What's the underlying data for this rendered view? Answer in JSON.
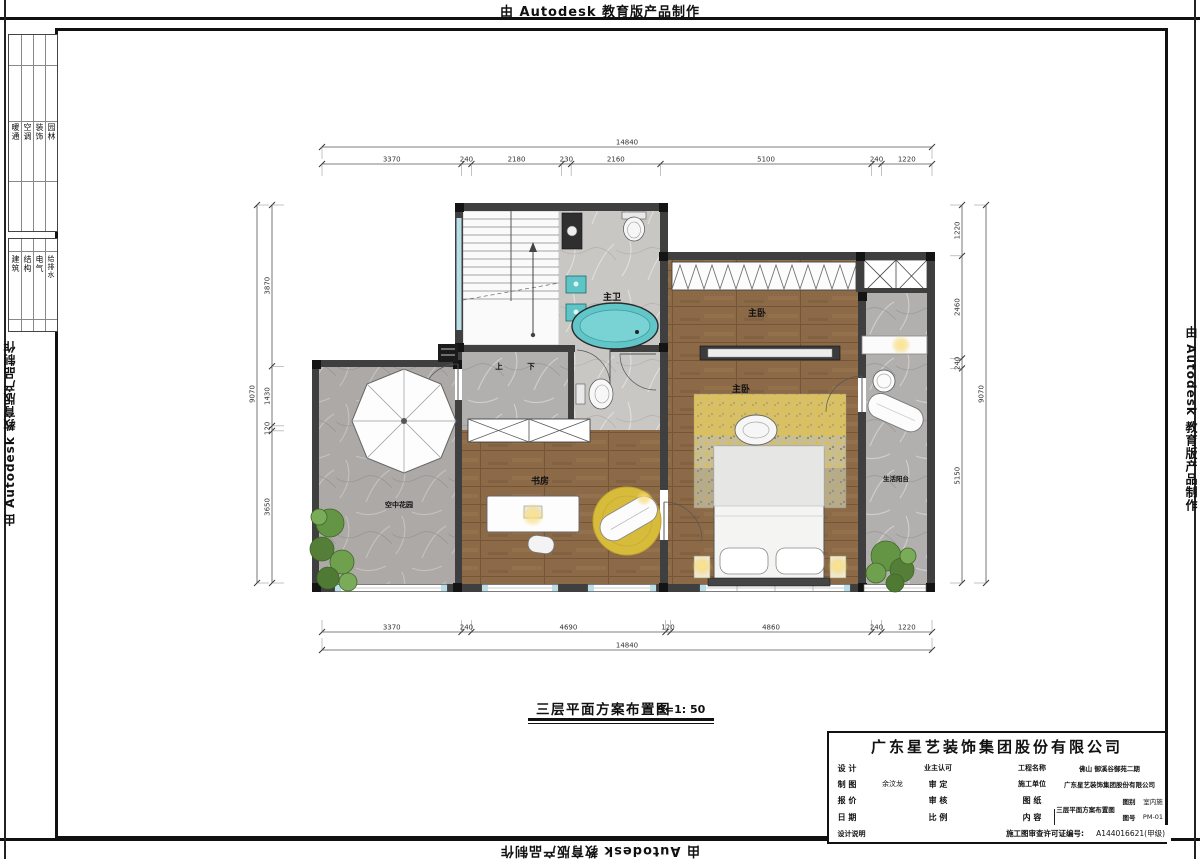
{
  "banners": {
    "autodesk": "由 Autodesk 教育版产品制作"
  },
  "side_tables": {
    "band1": [
      "暖通",
      "空调",
      "装饰",
      "园林"
    ],
    "band2": [
      "建筑",
      "结构",
      "电气",
      "给排水"
    ]
  },
  "plan": {
    "title": "三层平面方案布置图",
    "scale_text": "S=1: 50",
    "rooms": [
      {
        "label": "主卫"
      },
      {
        "label": "主卧"
      },
      {
        "label": "主卧"
      },
      {
        "label": "书房"
      },
      {
        "label": "空中花园"
      },
      {
        "label": "生活阳台"
      },
      {
        "label": "上"
      },
      {
        "label": "下"
      }
    ]
  },
  "dimensions": {
    "top_overall": "14840",
    "top_segments": [
      "3370",
      "240",
      "2180",
      "230",
      "2160",
      "5100",
      "240",
      "1220"
    ],
    "bottom_overall": "14840",
    "bottom_segments": [
      "3370",
      "240",
      "4690",
      "120",
      "4860",
      "240",
      "1220"
    ],
    "left_overall": "9070",
    "left_segments": [
      "3870",
      "1430",
      "120",
      "3650"
    ],
    "right_overall": "9070",
    "right_segments": [
      "1220",
      "2460",
      "240",
      "5150"
    ]
  },
  "title_block": {
    "company": "广东星艺装饰集团股份有限公司",
    "fields": {
      "design_label": "设 计",
      "owner_label": "业主认可",
      "project_label": "工程名称",
      "project_value": "佛山 御溪谷御苑二期",
      "draft_label": "制 图",
      "draft_value": "余汶龙",
      "approve_label": "审 定",
      "contractor_label": "施工单位",
      "contractor_value": "广东星艺装饰集团股份有限公司",
      "quote_label": "报 价",
      "check_label": "审 核",
      "drawing_label": "图 纸",
      "content_label": "内 容",
      "drawing_value": "三层平面方案布置图",
      "category_label": "图别",
      "category_value": "室内施",
      "number_label": "图号",
      "number_value": "PM-01",
      "date_label": "日 期",
      "scale_label": "比 例",
      "notes_label": "设计说明",
      "permit_label": "施工图审查许可证编号:",
      "permit_value": "A144016621(甲级)"
    }
  },
  "colors": {
    "wood": "#8d6a47",
    "marble": "#b2b0ae",
    "teal_fixture": "#5fc4c6",
    "glass": "#b8dfe8",
    "wall": "#3f3f3f",
    "accent_yellow": "#e0bf3c",
    "plant_green": "#639545"
  }
}
